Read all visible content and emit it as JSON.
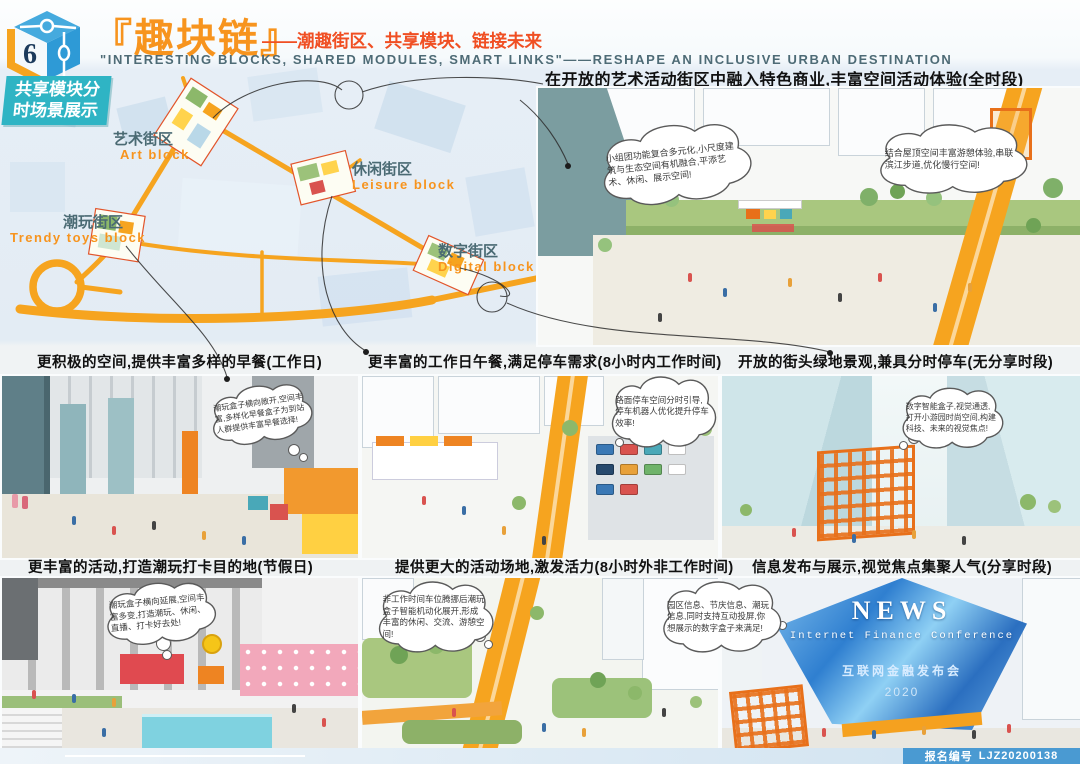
{
  "header": {
    "logo_number": "6",
    "title": "『趣块链』",
    "title_suffix": "——潮趣街区、共享模块、链接未来",
    "subtitle": "\"INTERESTING BLOCKS, SHARED MODULES, SMART LINKS\"——RESHAPE AN INCLUSIVE URBAN DESTINATION"
  },
  "badge": {
    "line1": "共享模块分",
    "line2": "时场景展示"
  },
  "map": {
    "blocks": [
      {
        "cn": "艺术街区",
        "en": "Art block"
      },
      {
        "cn": "休闲街区",
        "en": "Leisure block"
      },
      {
        "cn": "潮玩街区",
        "en": "Trendy toys block"
      },
      {
        "cn": "数字街区",
        "en": "Digital block"
      }
    ]
  },
  "hero": {
    "caption": "在开放的艺术活动街区中融入特色商业,丰富空间活动体验(全时段)",
    "bubble_left": "小组团功能复合多元化,小尺度建筑与生态空间有机融合,平添艺术、休闲、展示空间!",
    "bubble_right": "结合屋顶空间丰富游憩体验,串联滨江步道,优化慢行空间!"
  },
  "mid": [
    {
      "caption": "更积极的空间,提供丰富多样的早餐(工作日)",
      "bubble": "潮玩盒子横向敞开,空间丰富,多样化早餐盒子为到站人群提供丰富早餐选择!"
    },
    {
      "caption": "更丰富的工作日午餐,满足停车需求(8小时内工作时间)",
      "bubble": "路面停车空间分时引导,停车机器人优化提升停车效率!"
    },
    {
      "caption": "开放的街头绿地景观,兼具分时停车(无分享时段)",
      "bubble": "数字智能盒子,视觉通透,打开小游园时尚空间,构建科技、未来的视觉焦点!"
    }
  ],
  "bottom": [
    {
      "caption": "更丰富的活动,打造潮玩打卡目的地(节假日)",
      "bubble": "潮玩盒子横向延展,空间丰富多变,打造潮玩、休闲、直播、打卡好去处!"
    },
    {
      "caption": "提供更大的活动场地,激发活力(8小时外非工作时间)",
      "bubble": "非工作时间车位腾挪后潮玩盒子智能机动化展开,形成丰富的休闲、交流、游憩空间!"
    },
    {
      "caption": "信息发布与展示,视觉焦点集聚人气(分享时段)",
      "bubble": "园区信息、节庆信息、潮玩信息,同时支持互动投屏,你想展示的数字盒子来满足!"
    }
  ],
  "news": {
    "title": "NEWS",
    "subtitle": "Internet Finance Conference",
    "cn": "互联网金融发布会",
    "year": "2020"
  },
  "footer": {
    "label": "报名编号",
    "number": "LJZ20200138"
  },
  "colors": {
    "accent_orange": "#f7941e",
    "red_orange": "#f04f23",
    "badge_cyan": "#2fb4c4",
    "road_orange": "#f6a41f",
    "crystal_blue": "#2f7fd0",
    "footer_blue": "#4a9ad2"
  }
}
